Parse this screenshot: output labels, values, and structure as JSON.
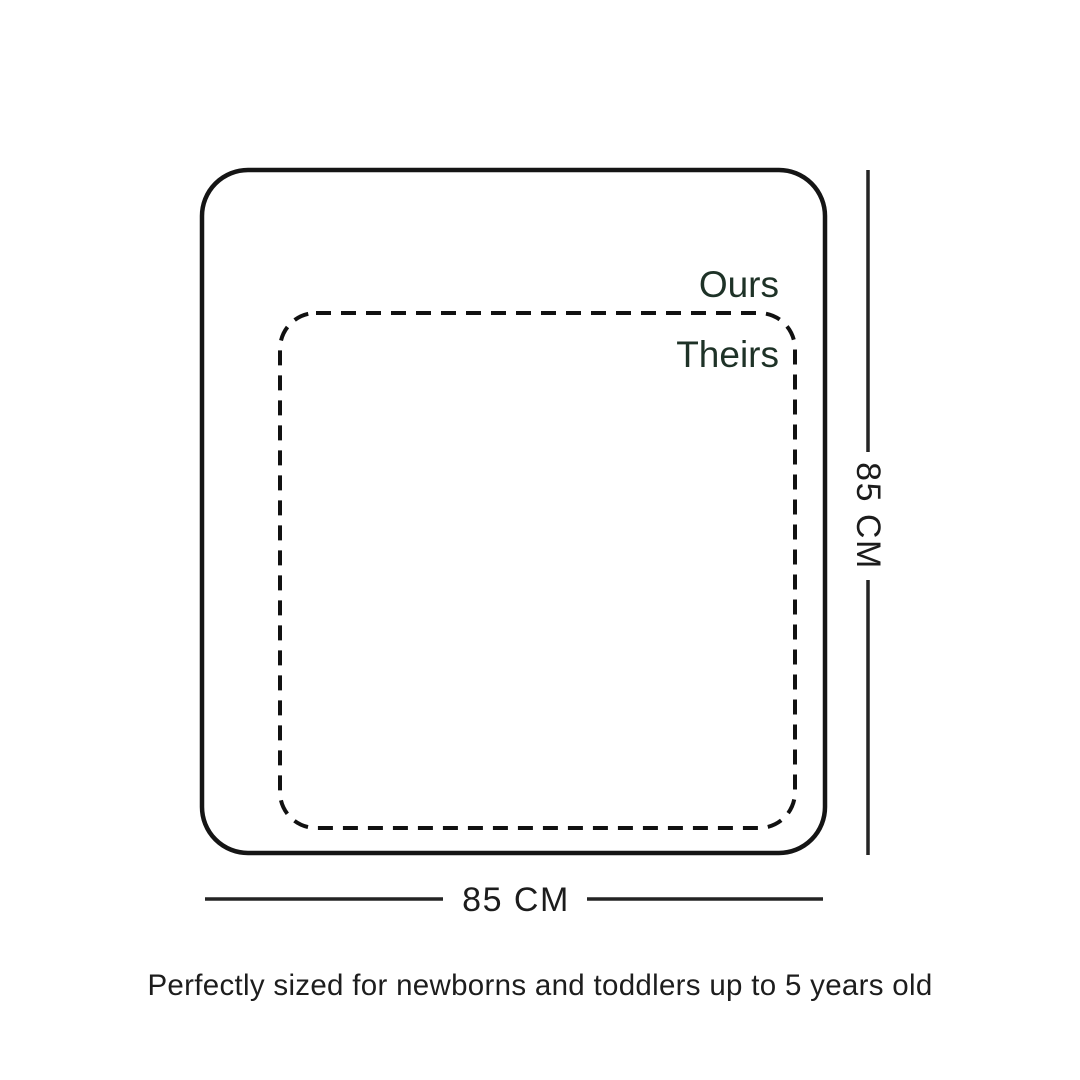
{
  "infographic": {
    "ours": {
      "label": "Ours"
    },
    "theirs": {
      "label": "Theirs"
    },
    "width_dimension": {
      "label": "85 CM"
    },
    "height_dimension": {
      "label": "85 CM"
    },
    "caption": "Perfectly sized for newborns and toddlers up to 5 years old",
    "colors": {
      "background": "#ffffff",
      "solid_outline": "#151515",
      "dashed_outline": "#111111",
      "label_green": "#1e3227",
      "dimension_line": "#242424",
      "dimension_text": "#1c1c1c",
      "caption_text": "#1d1d1d"
    }
  }
}
